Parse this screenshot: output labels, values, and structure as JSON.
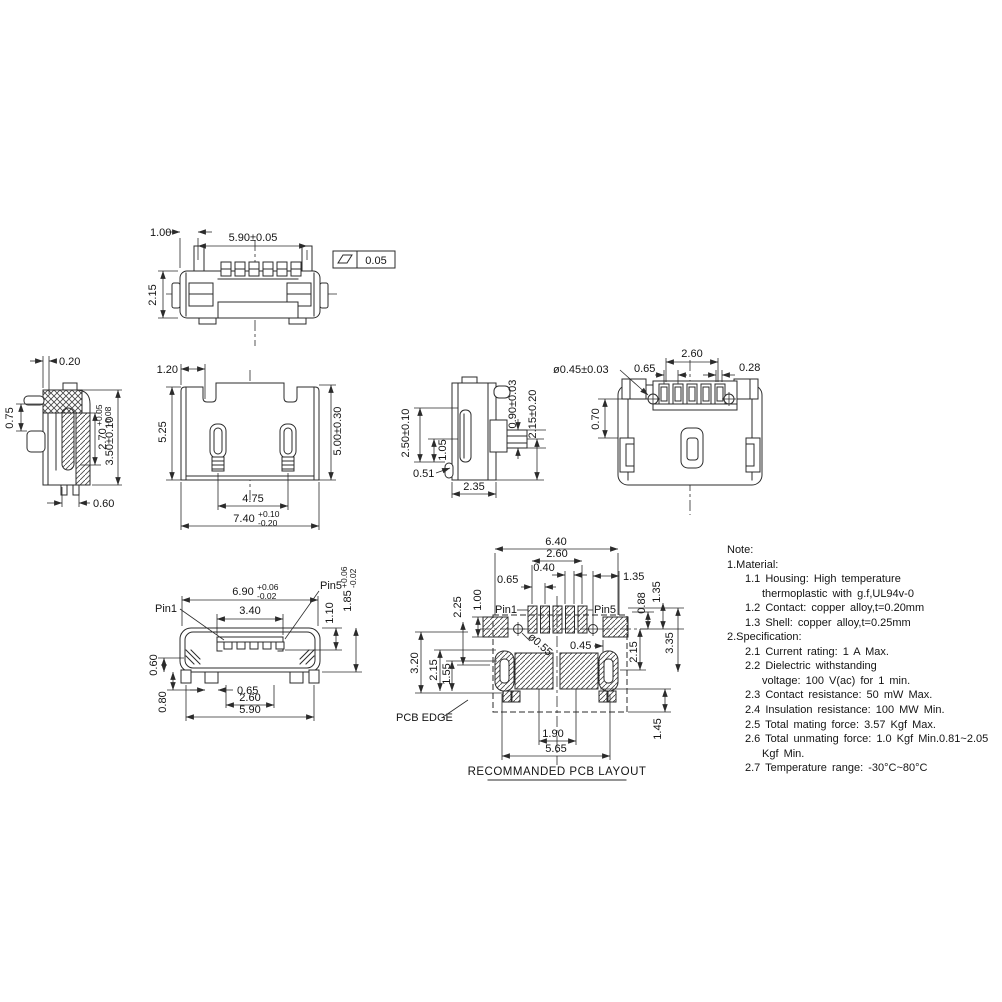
{
  "page": {
    "background": "#ffffff",
    "line_color": "#2b2b2b"
  },
  "views": {
    "top": {
      "d_offset": "1.00",
      "d_width": "5.90±0.05",
      "d_height": "2.15",
      "flatness": "0.05"
    },
    "section": {
      "d_wall": "0.20",
      "d_pin": "0.75",
      "d_depth": {
        "base": "2.70",
        "plus": "+0.05",
        "minus": "-0.08"
      },
      "d_height": "3.50±0.10",
      "d_foot": "0.60"
    },
    "front": {
      "d_notch": "1.20",
      "d_h_left": "5.25",
      "d_h_right": "5.00±0.30",
      "d_span": "4.75",
      "d_width": {
        "base": "7.40",
        "plus": "+0.10",
        "minus": "-0.20"
      }
    },
    "side": {
      "d_shell": "2.50±0.10",
      "d_slot": "1.05",
      "d_tip": "0.51",
      "d_depth": "2.35",
      "d_pin": "0.90±0.03",
      "d_height": "2.15±0.20"
    },
    "bottom": {
      "d_hole": "ø0.45±0.03",
      "d_span": "2.60",
      "d_pitch": "0.65",
      "d_pin": "0.28",
      "d_hole_off": "0.70"
    },
    "mating": {
      "pin_first": "Pin1",
      "pin_last": "Pin5",
      "d_width": {
        "base": "6.90",
        "plus": "+0.06",
        "minus": "-0.02"
      },
      "d_tongue": "3.40",
      "d_tongue_h": "1.10",
      "d_face_h": {
        "base": "1.85",
        "plus": "+0.06",
        "minus": "-0.02"
      },
      "d_shell_b": "0.60",
      "d_foot_h": "0.80",
      "d_foot_w": "0.65",
      "d_feet": "2.60",
      "d_total": "5.90"
    },
    "pcb": {
      "pin_first": "Pin1",
      "pin_last": "Pin5",
      "d_total_w": "6.40",
      "d_span": "2.60",
      "d_pad_w": "0.40",
      "d_pitch": "0.65",
      "d_off_r": "1.35",
      "d_r_135": "1.35",
      "d_r_088": "0.88",
      "d_r_335": "3.35",
      "d_r_215": "2.15",
      "d_r_145": "1.45",
      "d_l_225": "2.25",
      "d_l_100": "1.00",
      "d_l_320": "3.20",
      "d_l_215": "2.15",
      "d_l_155": "1.55",
      "d_hole": "ø0.55",
      "d_mid": "0.45",
      "d_b_190": "1.90",
      "d_b_565": "5.65",
      "edge_label": "PCB EDGE",
      "caption": "RECOMMANDED PCB LAYOUT"
    }
  },
  "note": {
    "lines": [
      "Note:",
      "1.Material:",
      "1.1 Housing: High temperature",
      "thermoplastic with g.f,UL94v-0",
      "1.2 Contact: copper alloy,t=0.20mm",
      "1.3 Shell: copper alloy,t=0.25mm",
      "2.Specification:",
      "2.1 Current rating: 1 A Max.",
      "2.2 Dielectric withstanding",
      "voltage: 100 V(ac) for 1 min.",
      "2.3 Contact resistance: 50 mW Max.",
      "2.4 Insulation resistance: 100 MW Min.",
      "2.5 Total mating force: 3.57 Kgf Max.",
      "2.6 Total unmating force: 1.0 Kgf Min.0.81~2.05",
      "Kgf Min.",
      "2.7 Temperature range: -30°C~80°C"
    ]
  }
}
